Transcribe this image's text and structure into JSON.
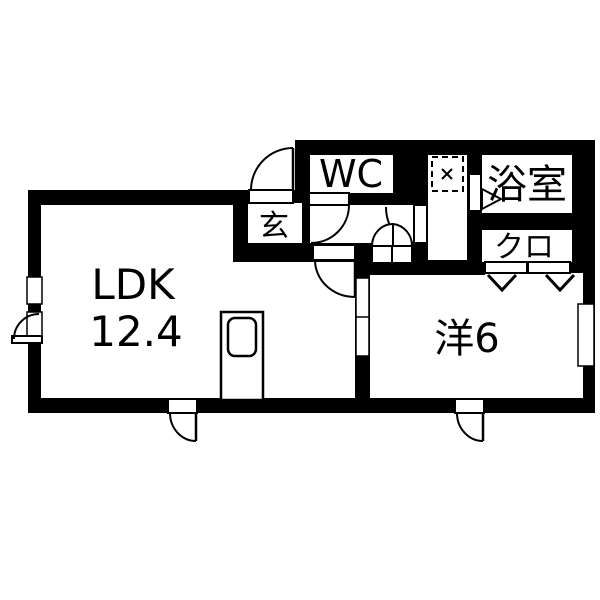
{
  "plan": {
    "type": "floor-plan",
    "rooms": {
      "ldk": {
        "label": "LDK",
        "size_label": "12.4"
      },
      "western": {
        "label": "洋6"
      },
      "wc": {
        "label": "WC"
      },
      "bathroom": {
        "label": "浴室"
      },
      "closet": {
        "label": "クロ"
      },
      "entrance": {
        "label": "玄"
      }
    },
    "colors": {
      "wall": "#000000",
      "floor": "#ffffff",
      "line": "#000000"
    }
  }
}
